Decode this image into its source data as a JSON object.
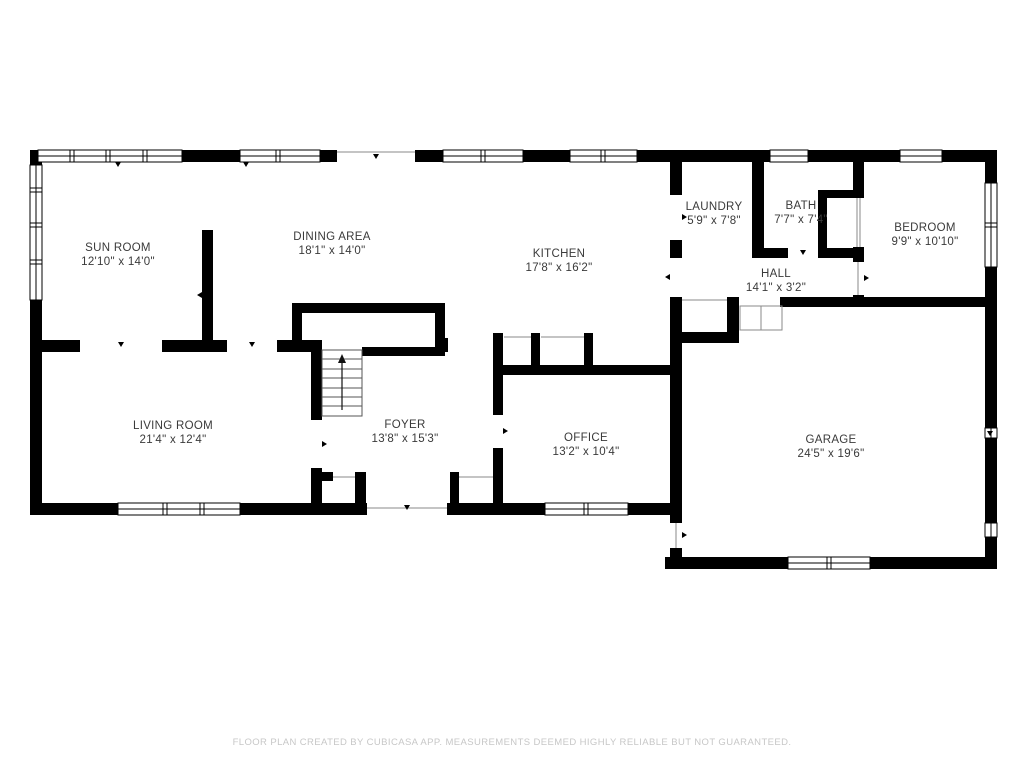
{
  "rooms": [
    {
      "name": "SUN ROOM",
      "dims": "12'10\" x 14'0\""
    },
    {
      "name": "DINING AREA",
      "dims": "18'1\" x 14'0\""
    },
    {
      "name": "KITCHEN",
      "dims": "17'8\" x 16'2\""
    },
    {
      "name": "LAUNDRY",
      "dims": "5'9\" x 7'8\""
    },
    {
      "name": "BATH",
      "dims": "7'7\" x 7'4\""
    },
    {
      "name": "BEDROOM",
      "dims": "9'9\" x 10'10\""
    },
    {
      "name": "HALL",
      "dims": "14'1\" x 3'2\""
    },
    {
      "name": "LIVING ROOM",
      "dims": "21'4\" x 12'4\""
    },
    {
      "name": "FOYER",
      "dims": "13'8\" x 15'3\""
    },
    {
      "name": "OFFICE",
      "dims": "13'2\" x 10'4\""
    },
    {
      "name": "GARAGE",
      "dims": "24'5\" x 19'6\""
    }
  ],
  "footer": {
    "disclaimer": "FLOOR PLAN CREATED BY CUBICASA APP. MEASUREMENTS DEEMED HIGHLY RELIABLE BUT NOT GUARANTEED."
  },
  "colors": {
    "wall": "#000000",
    "background": "#ffffff",
    "label_text": "#3a3a3a",
    "footer_text": "#c7c7c7",
    "thin_line": "#8a8a8a"
  }
}
